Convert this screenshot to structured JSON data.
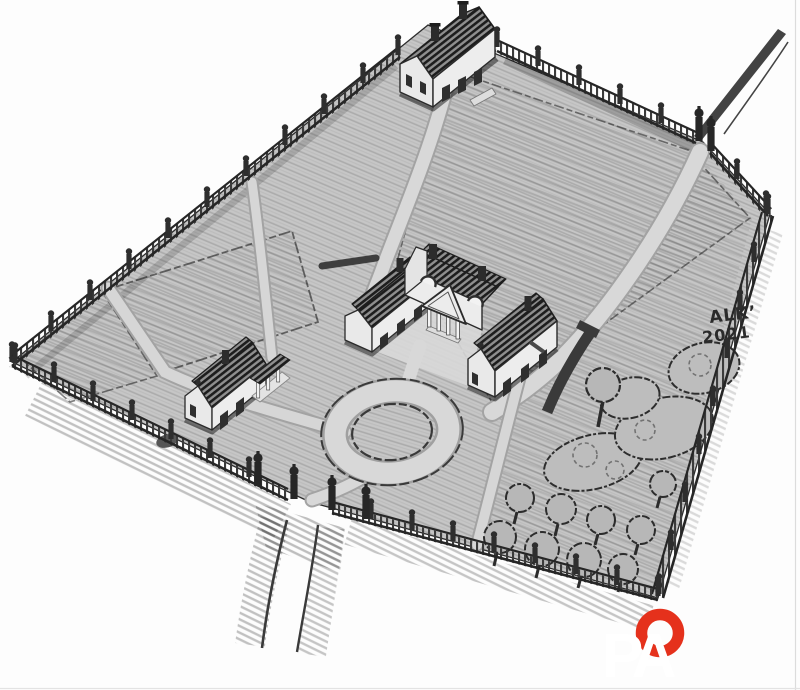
{
  "artwork": {
    "signature": {
      "line1": "ALK’",
      "line2": "2021"
    },
    "watermark": {
      "letters": "PA"
    },
    "colors": {
      "paper": "#fdfdfd",
      "ground": "#c6c6c6",
      "path_light": "#d8d8d8",
      "ink": "#2b2b2b",
      "accent_red": "#e5311c",
      "watermark_white": "#ffffff"
    }
  }
}
